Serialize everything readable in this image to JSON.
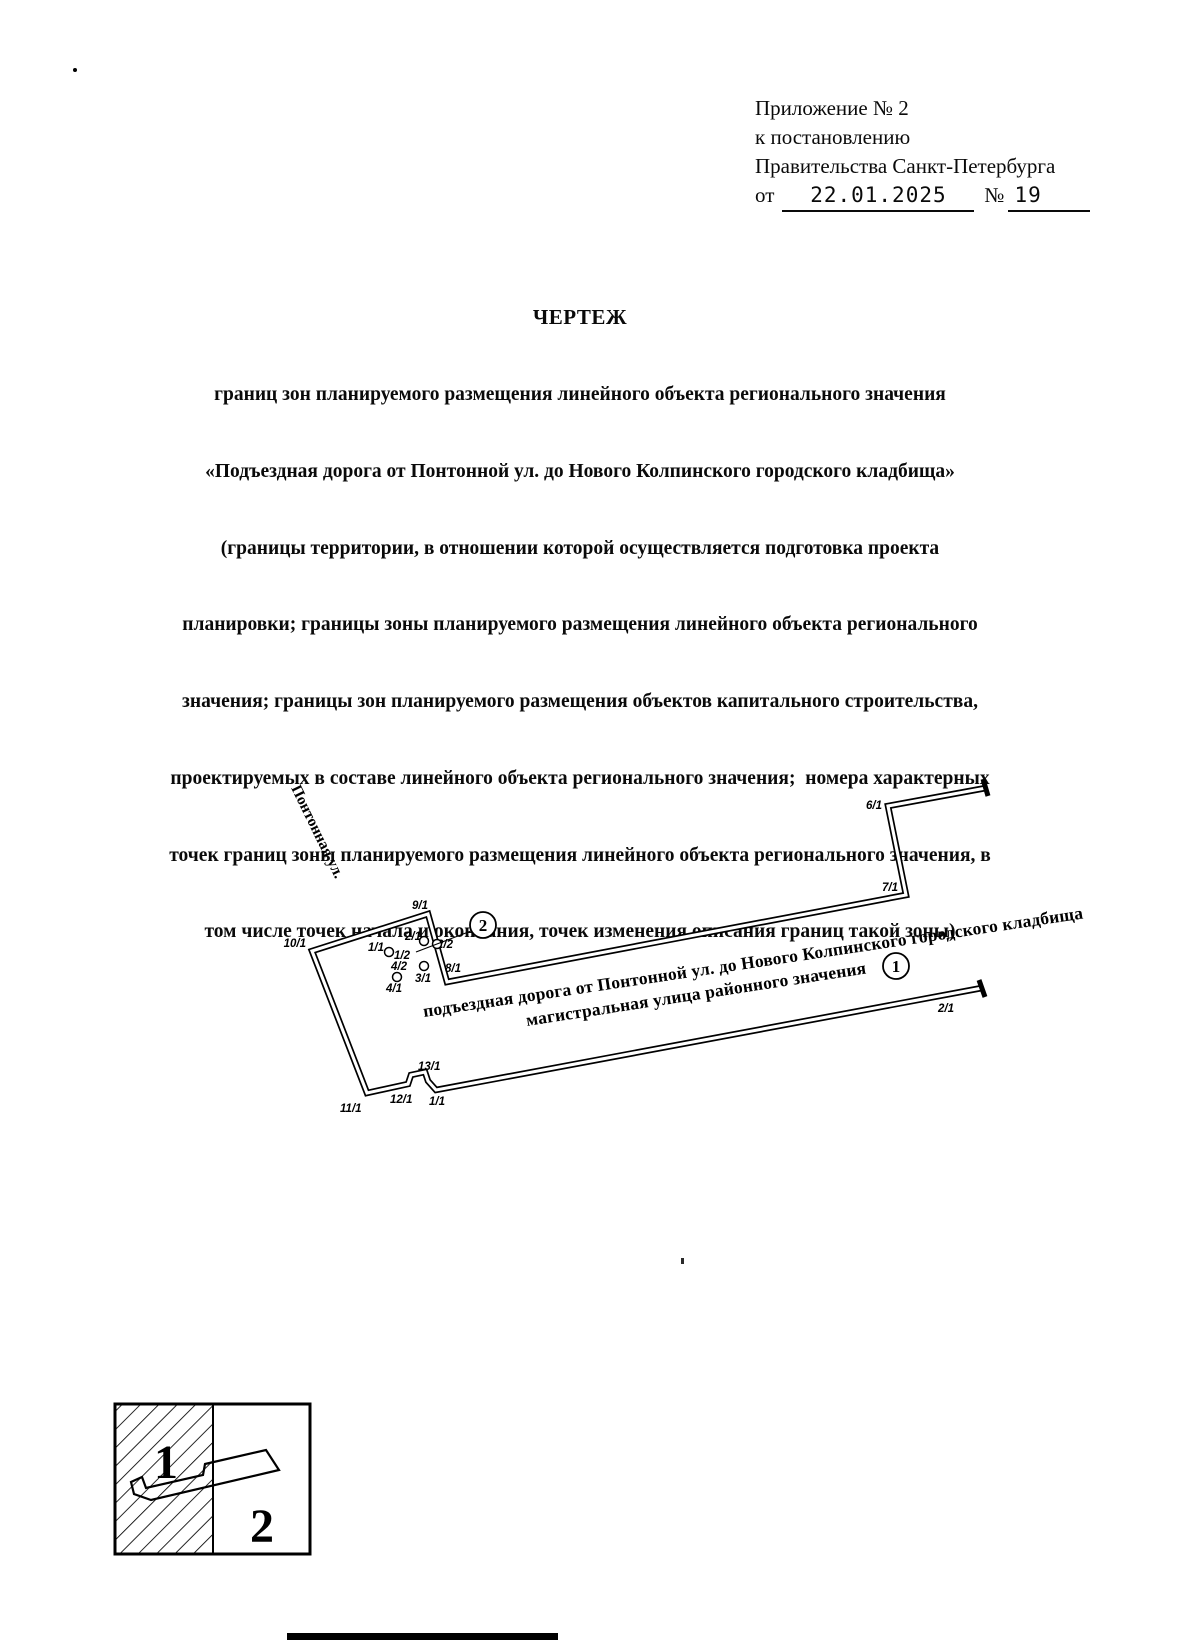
{
  "annex": {
    "line1": "Приложение № 2",
    "line2": "к постановлению",
    "line3": "Правительства Санкт-Петербурга",
    "from_label": "от",
    "date": "22.01.2025",
    "no_sign": "№",
    "number": "19"
  },
  "title": {
    "heading": "ЧЕРТЕЖ",
    "lines": [
      "границ зон планируемого размещения линейного объекта регионального значения",
      "«Подъездная дорога от Понтонной ул. до Нового Колпинского городского кладбища»",
      "(границы территории, в отношении которой осуществляется подготовка проекта",
      "планировки; границы зоны планируемого размещения линейного объекта регионального",
      "значения; границы зон планируемого размещения объектов капитального строительства,",
      "проектируемых в составе линейного объекта регионального значения;  номера характерных",
      "точек границ зоны планируемого размещения линейного объекта регионального значения, в",
      "том числе точек начала и окончания, точек изменения описания границ такой зоны)"
    ]
  },
  "map": {
    "street_label": "Понтонная ул.",
    "road_name_line1": "подъездная дорога от Понтонной ул. до Нового Колпинского городского кладбища",
    "road_name_line2": "магистральная улица районного значения",
    "callout_1": "1",
    "callout_2": "2",
    "points": {
      "p9_1": "9/1",
      "p10_1": "10/1",
      "p2_1": "2/1",
      "p2_2": "2/2",
      "p1_1": "1/1",
      "p1_2": "1/2",
      "p4_2": "4/2",
      "p4_1": "4/1",
      "p3_1": "3/1",
      "p8_1": "8/1",
      "p11_1": "11/1",
      "p12_1": "12/1",
      "p13_1": "13/1",
      "p1_1b": "1/1",
      "p2_1b": "2/1",
      "p6_1": "6/1",
      "p7_1": "7/1"
    }
  },
  "legend": {
    "item1": "1",
    "item2": "2"
  }
}
